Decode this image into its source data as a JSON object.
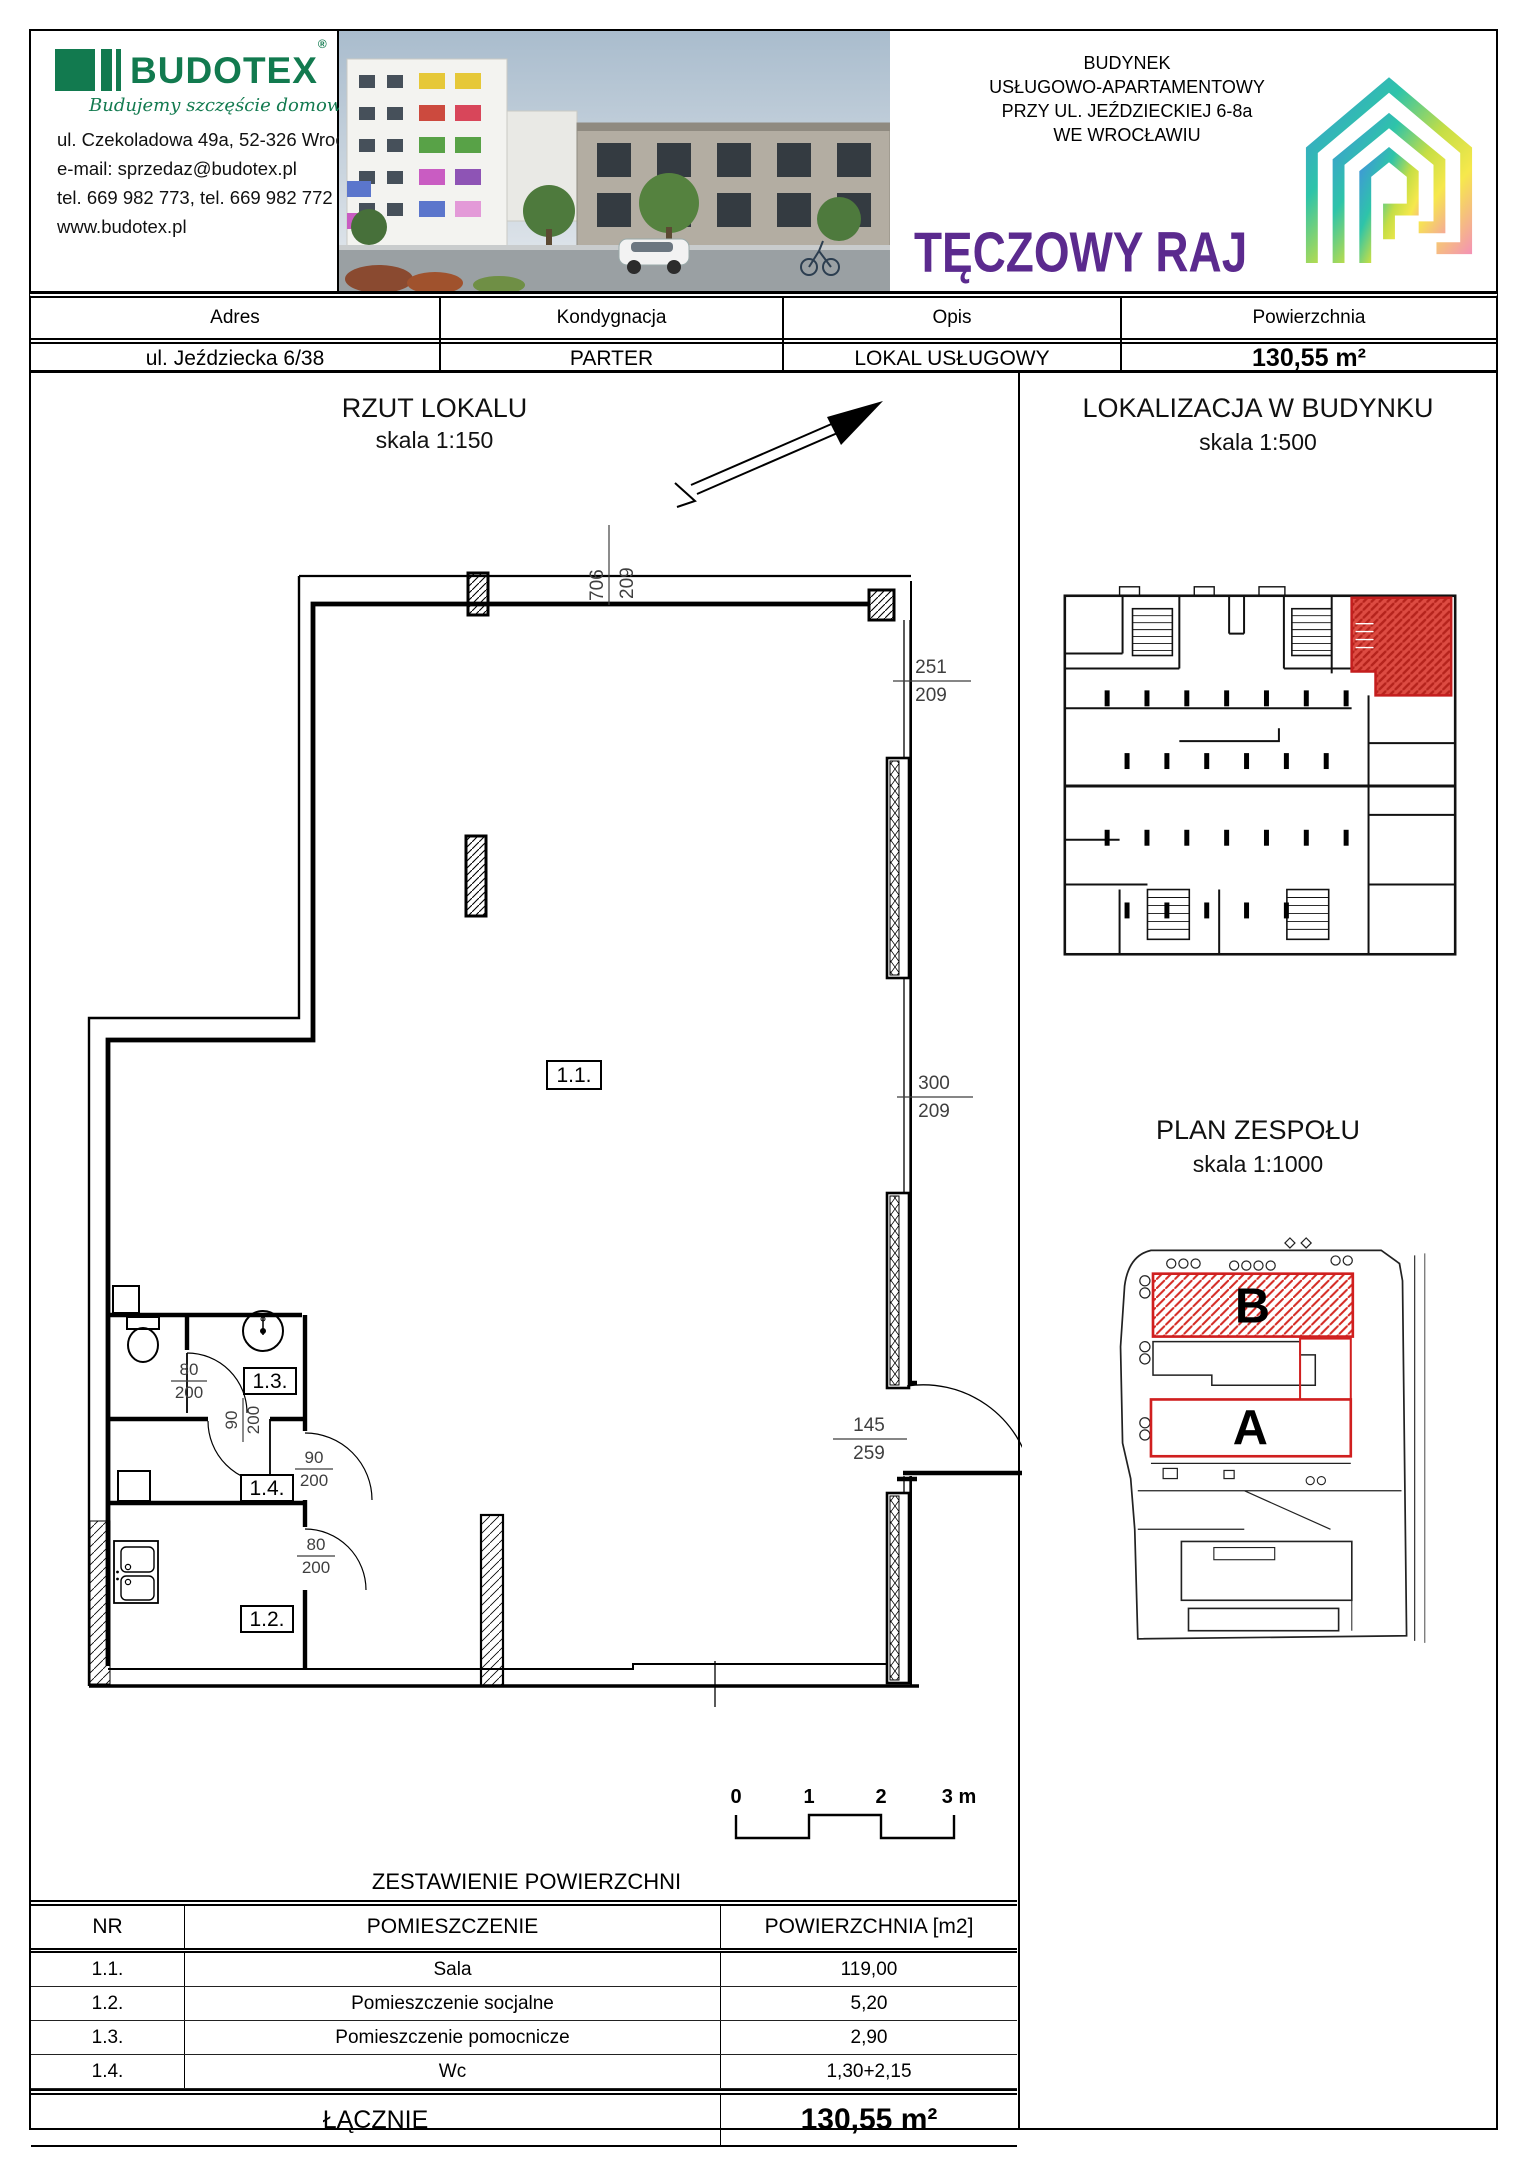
{
  "colors": {
    "brand_green": "#127a4f",
    "brand_purple": "#5b2a8e",
    "dimension_red": "#b23b38",
    "highlight_red": "#d01f1f"
  },
  "header": {
    "company": {
      "name": "BUDOTEX",
      "reg": "®",
      "tagline": "Budujemy szczęście domowego ogniska",
      "address": "ul. Czekoladowa 49a, 52-326 Wrocław",
      "email": "e-mail: sprzedaz@budotex.pl",
      "phone": "tel. 669 982 773, tel. 669 982 772",
      "website": "www.budotex.pl"
    },
    "project": {
      "line1": "BUDYNEK",
      "line2": "USŁUGOWO-APARTAMENTOWY",
      "line3": "PRZY UL. JEŹDZIECKIEJ 6-8a",
      "line4": "WE WROCŁAWIU",
      "name": "TĘCZOWY RAJ"
    }
  },
  "info_bar": {
    "columns": [
      {
        "label": "Adres",
        "value": "ul. Jeździecka 6/38"
      },
      {
        "label": "Kondygnacja",
        "value": "PARTER"
      },
      {
        "label": "Opis",
        "value": "LOKAL USŁUGOWY"
      },
      {
        "label": "Powierzchnia",
        "value": "130,55 m²"
      }
    ]
  },
  "floorplan": {
    "title": "RZUT LOKALU",
    "scale": "skala 1:150",
    "rooms": {
      "r11": "1.1.",
      "r12": "1.2.",
      "r13": "1.3.",
      "r14": "1.4."
    },
    "dims": {
      "top": {
        "n": "706",
        "d": "209"
      },
      "right_upper": {
        "n": "251",
        "d": "209"
      },
      "right_middle": {
        "n": "300",
        "d": "209"
      },
      "entry": {
        "n": "145",
        "d": "259"
      },
      "door13": {
        "n": "80",
        "d": "200"
      },
      "door134": {
        "n": "90",
        "d": "200"
      },
      "door14": {
        "n": "90",
        "d": "200"
      },
      "door12": {
        "n": "80",
        "d": "200"
      }
    },
    "scalebar": [
      "0",
      "1",
      "2",
      "3 m"
    ]
  },
  "location": {
    "title": "LOKALIZACJA W BUDYNKU",
    "scale": "skala 1:500"
  },
  "site": {
    "title": "PLAN ZESPOŁU",
    "scale": "skala 1:1000",
    "a": "A",
    "b": "B"
  },
  "areas": {
    "title": "ZESTAWIENIE POWIERZCHNI",
    "headers": [
      "NR",
      "POMIESZCZENIE",
      "POWIERZCHNIA [m2]"
    ],
    "rows": [
      [
        "1.1.",
        "Sala",
        "119,00"
      ],
      [
        "1.2.",
        "Pomieszczenie socjalne",
        "5,20"
      ],
      [
        "1.3.",
        "Pomieszczenie pomocnicze",
        "2,90"
      ],
      [
        "1.4.",
        "Wc",
        "1,30+2,15"
      ]
    ],
    "total_label": "ŁĄCZNIE",
    "total_value": "130,55 m²"
  }
}
